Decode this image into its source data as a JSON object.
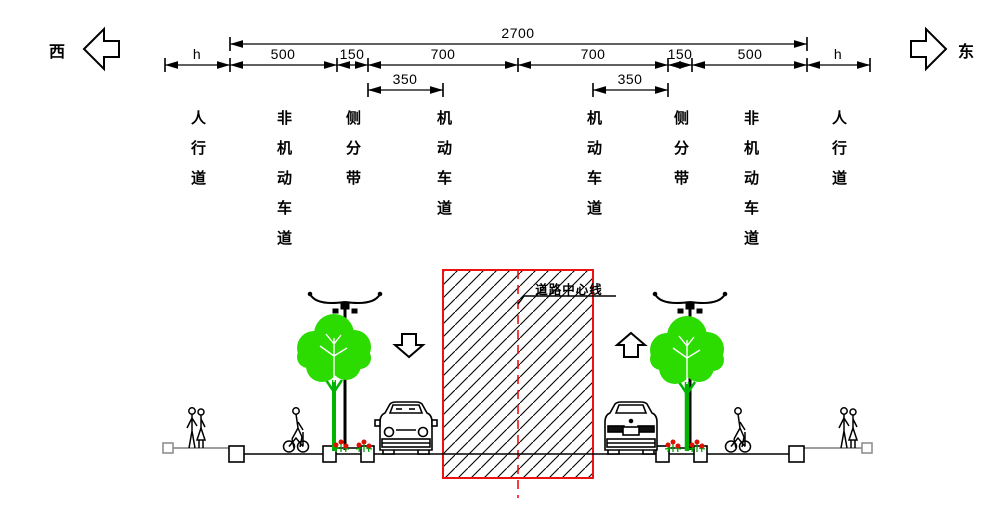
{
  "direction": {
    "west": "西",
    "east": "东"
  },
  "dimensions": {
    "total": "2700",
    "segments": [
      "h",
      "500",
      "150",
      "700",
      "700",
      "150",
      "500",
      "h"
    ],
    "half_lane_left": "350",
    "half_lane_right": "350"
  },
  "lanes": [
    {
      "label": "人行道"
    },
    {
      "label": "非机动车道"
    },
    {
      "label": "侧分带"
    },
    {
      "label": "机动车道"
    },
    {
      "label": "机动车道"
    },
    {
      "label": "侧分带"
    },
    {
      "label": "非机动车道"
    },
    {
      "label": "人行道"
    }
  ],
  "centerline_label": "道路中心线",
  "colors": {
    "line_black": "#000000",
    "construction_red": "#ee1111",
    "tree_green": "#2cdb00",
    "trunk_green": "#00b400",
    "stem_green": "#00a000",
    "flower_red": "#dd1100",
    "sidewalk_gray": "#8f8f8f"
  }
}
